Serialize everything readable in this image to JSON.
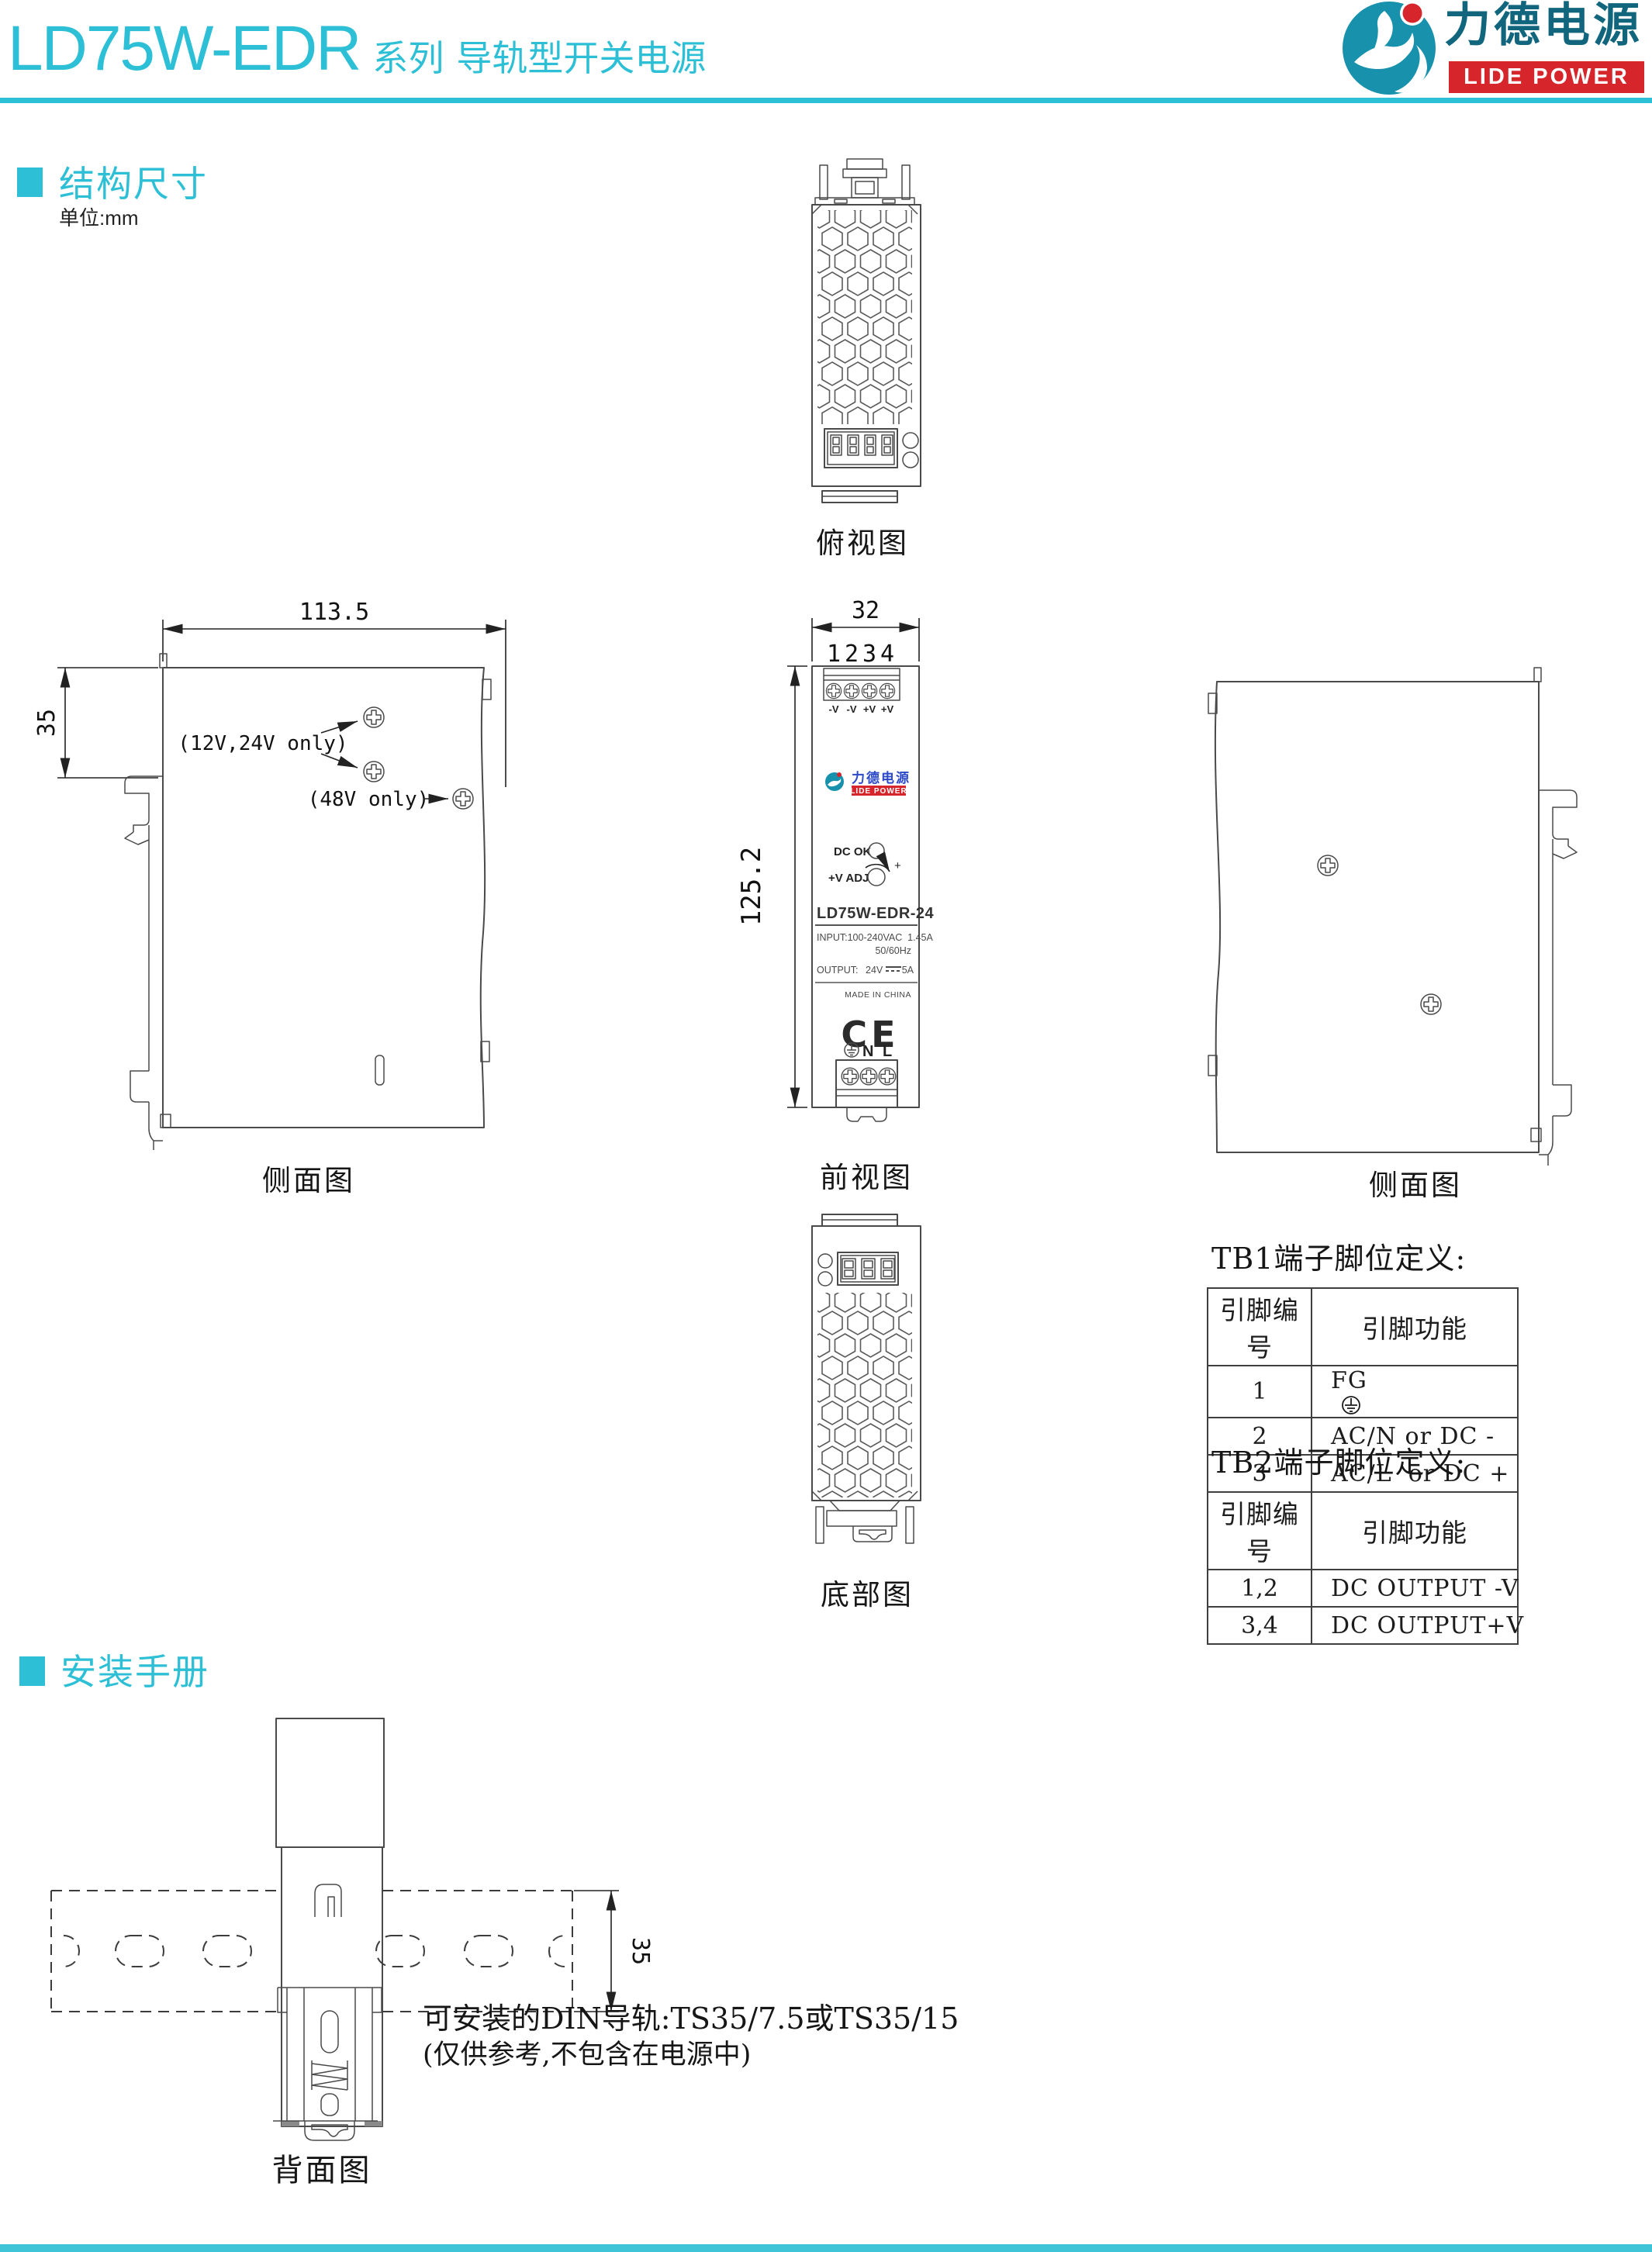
{
  "colors": {
    "accent": "#2cbfd5",
    "brand_red": "#d6252b",
    "brand_teal_dark": "#11667e",
    "logo_circle": "#1791ac",
    "front_label_blue": "#2b49c8",
    "drawing_line": "#4a4a4a"
  },
  "header": {
    "model": "LD75W-EDR",
    "series": "系列",
    "product": "导轨型开关电源",
    "logo_zh": "力德电源",
    "logo_en": "LIDE POWER"
  },
  "sections": {
    "dim_label": "结构尺寸",
    "dim_unit": "单位:mm",
    "install_label": "安装手册"
  },
  "views": {
    "top": {
      "caption": "俯视图"
    },
    "side_left": {
      "caption": "侧面图",
      "dim_width": "113.5",
      "dim_height": "35",
      "note_screws_12_24": "(12V,24V only)",
      "note_screw_48": "(48V only)"
    },
    "front": {
      "caption": "前视图",
      "dim_width": "32",
      "dim_height": "125.2",
      "pin_numbers": [
        "1",
        "2",
        "3",
        "4"
      ],
      "terminals_top": [
        "-V",
        "-V",
        "+V",
        "+V"
      ],
      "logo_zh": "力德电源",
      "logo_en": "LIDE POWER",
      "led_label": "DC OK",
      "adj_label": "+V ADJ",
      "adj_plus": "+",
      "model": "LD75W-EDR-24",
      "input_line1": "INPUT:100-240VAC  1.45A",
      "input_line2": "50/60Hz",
      "output_label": "OUTPUT:",
      "output_voltage": "24V",
      "output_current": "5A",
      "made_in": "MADE IN CHINA",
      "ce_mark": "CE",
      "ac_n": "N",
      "ac_l": "L"
    },
    "side_right": {
      "caption": "侧面图"
    },
    "bottom": {
      "caption": "底部图"
    },
    "back": {
      "caption": "背面图",
      "dim_rail": "35",
      "rail_note1": "可安装的DIN导轨:TS35/7.5或TS35/15",
      "rail_note2": "(仅供参考,不包含在电源中)"
    }
  },
  "tables": {
    "tb1": {
      "title": "TB1端子脚位定义:",
      "col_pin": "引脚编号",
      "col_func": "引脚功能",
      "rows": [
        {
          "pin": "1",
          "func": "FG",
          "icon": "earth-ground-icon"
        },
        {
          "pin": "2",
          "func": "AC/N or DC -"
        },
        {
          "pin": "3",
          "func": "AC/L  or DC +"
        }
      ]
    },
    "tb2": {
      "title": "TB2端子脚位定义:",
      "col_pin": "引脚编号",
      "col_func": "引脚功能",
      "rows": [
        {
          "pin": "1,2",
          "func": "DC OUTPUT -V"
        },
        {
          "pin": "3,4",
          "func": "DC OUTPUT+V"
        }
      ]
    }
  }
}
